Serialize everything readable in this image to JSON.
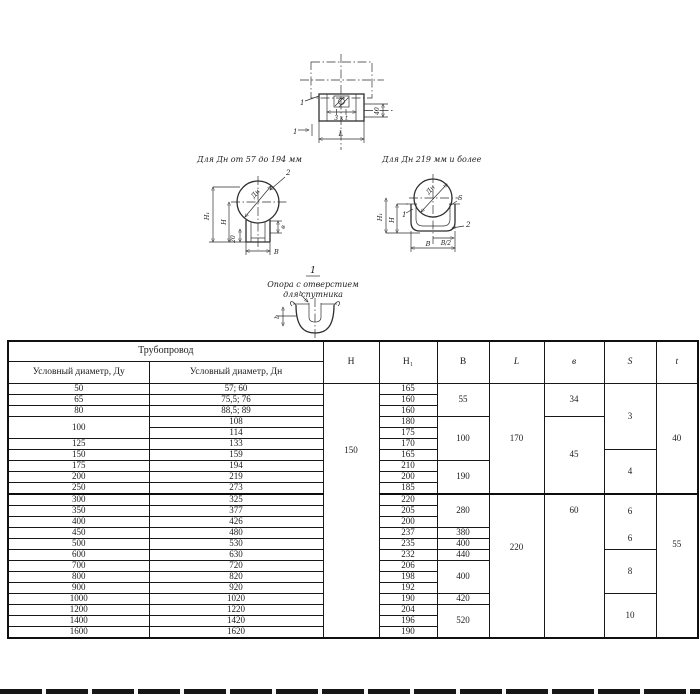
{
  "drawings": {
    "top_view": {
      "part_label": "1",
      "section_label": "1",
      "dim_pitch": "3 х t",
      "dim_length": "L",
      "dim_width": "40"
    },
    "left_section": {
      "title": "Для Дн от 57 до 194 мм",
      "dim_diameter": "Дн",
      "dim_h1": "H₁",
      "dim_h": "H",
      "dim_20": "20",
      "dim_b": "В",
      "dim_v": "в",
      "part2_label": "2"
    },
    "right_section": {
      "title": "Для Дн 219 мм и более",
      "dim_diameter": "Дн",
      "dim_h1": "H₁",
      "dim_h": "H",
      "dim_s": "S",
      "dim_b2": "В/2",
      "dim_b": "В",
      "part1_label": "1",
      "part2_label": "2"
    },
    "note": {
      "section_title": "1",
      "caption_line1": "Опора с отверстием",
      "caption_line2": "для спутника",
      "dim_b_left": "b",
      "dim_b_top": "b"
    }
  },
  "table": {
    "header": {
      "pipeline": "Трубопровод",
      "du_label": "Условный диаметр, Ду",
      "dn_label": "Условный диаметр, Дн",
      "col_h": "H",
      "col_h1": "H₁",
      "col_b": "B",
      "col_l": "L",
      "col_v": "в",
      "col_s": "S",
      "col_t": "t"
    },
    "rows": [
      {
        "du": "50",
        "dn": "57; 60",
        "h1": "165"
      },
      {
        "du": "65",
        "dn": "75,5; 76",
        "h1": "160"
      },
      {
        "du": "80",
        "dn": "88,5; 89",
        "h1": "160"
      },
      {
        "du": "100",
        "dn": "108",
        "h1": "180"
      },
      {
        "dn": "114",
        "h1": "175"
      },
      {
        "du": "125",
        "dn": "133",
        "h1": "170"
      },
      {
        "du": "150",
        "dn": "159",
        "h1": "165"
      },
      {
        "du": "175",
        "dn": "194",
        "h1": "210"
      },
      {
        "du": "200",
        "dn": "219",
        "h1": "200"
      },
      {
        "du": "250",
        "dn": "273",
        "h1": "185"
      },
      {
        "du": "300",
        "dn": "325",
        "h1": "220"
      },
      {
        "du": "350",
        "dn": "377",
        "h1": "205"
      },
      {
        "du": "400",
        "dn": "426",
        "h1": "200"
      },
      {
        "du": "450",
        "dn": "480",
        "h1": "237"
      },
      {
        "du": "500",
        "dn": "530",
        "h1": "235"
      },
      {
        "du": "600",
        "dn": "630",
        "h1": "232"
      },
      {
        "du": "700",
        "dn": "720",
        "h1": "206"
      },
      {
        "du": "800",
        "dn": "820",
        "h1": "198"
      },
      {
        "du": "900",
        "dn": "920",
        "h1": "192"
      },
      {
        "du": "1000",
        "dn": "1020",
        "h1": "190"
      },
      {
        "du": "1200",
        "dn": "1220",
        "h1": "204"
      },
      {
        "du": "1400",
        "dn": "1420",
        "h1": "196"
      },
      {
        "du": "1600",
        "dn": "1620",
        "h1": "190"
      }
    ],
    "merged": {
      "h": "150",
      "b": [
        "55",
        "100",
        "190",
        "280",
        "380",
        "400",
        "440",
        "400",
        "420",
        "520"
      ],
      "l": [
        "170",
        "220"
      ],
      "v": [
        "34",
        "45",
        "60"
      ],
      "s": [
        "3",
        "4",
        "6",
        "6",
        "8",
        "10"
      ],
      "t": [
        "40",
        "55"
      ]
    }
  }
}
